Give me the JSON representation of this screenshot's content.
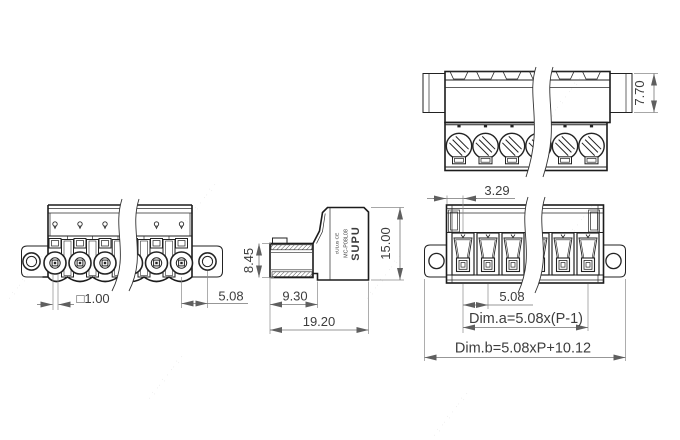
{
  "brand": {
    "name": "SUPU",
    "model": "MC-P08L08",
    "marks": "cULus CE"
  },
  "dims": {
    "front_pin": "□1.00",
    "front_flange_pitch": "5.08",
    "side_plug_height": "8.45",
    "side_plug_depth": "9.30",
    "side_total_depth": "19.20",
    "top_header_height": "7.70",
    "rear_edge_to_pole": "3.29",
    "rear_body_height": "15.00",
    "rear_pole_pitch": "5.08",
    "rear_dim_a": "Dim.a=5.08x(P-1)",
    "rear_dim_b": "Dim.b=5.08xP+10.12"
  },
  "watermark": {
    "text": "· : ·· : · ·· : ·"
  }
}
